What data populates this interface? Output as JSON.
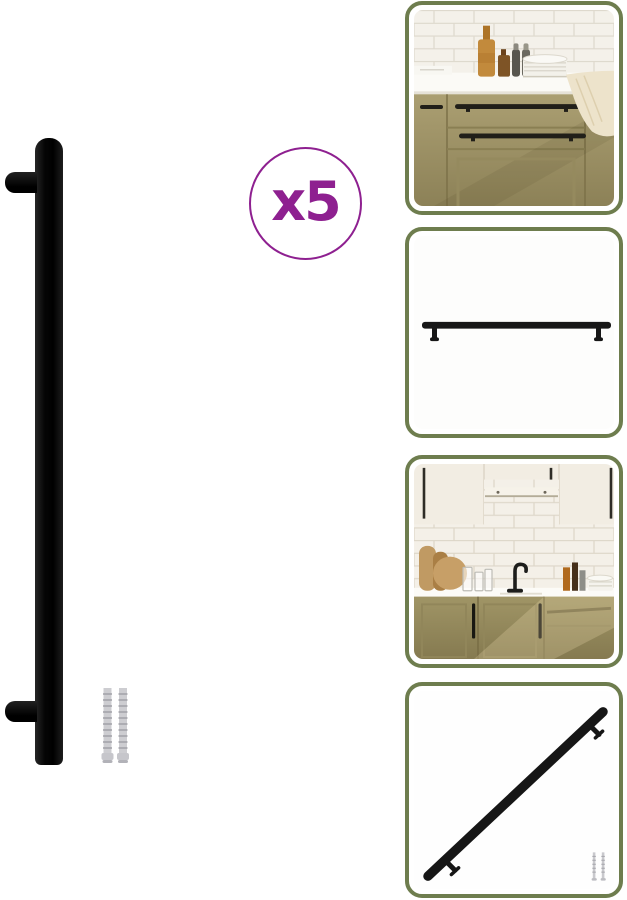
{
  "page": {
    "background_color": "#ffffff"
  },
  "badge": {
    "label": "x5"
  },
  "colors": {
    "accent-purple": "#8e2090",
    "thumb-border-green": "#6e7d4e",
    "handle-black": "#131313",
    "cabinet-olive": "#a39869",
    "tile-cream": "#f4f1ea",
    "screw-gray": "#c9c9cd"
  },
  "main_image": {
    "alt": "Black furniture bar handle with two mounting posts and two spare screws"
  },
  "thumbnails": [
    {
      "alt": "Kitchen drawers in olive green with long black bar handles mounted"
    },
    {
      "alt": "Black bar handle shown horizontally on white background"
    },
    {
      "alt": "Kitchen with tiled wall, sink and black handles on cream and olive cabinets"
    },
    {
      "alt": "Black bar handle shown diagonally with two mounting screws"
    }
  ]
}
